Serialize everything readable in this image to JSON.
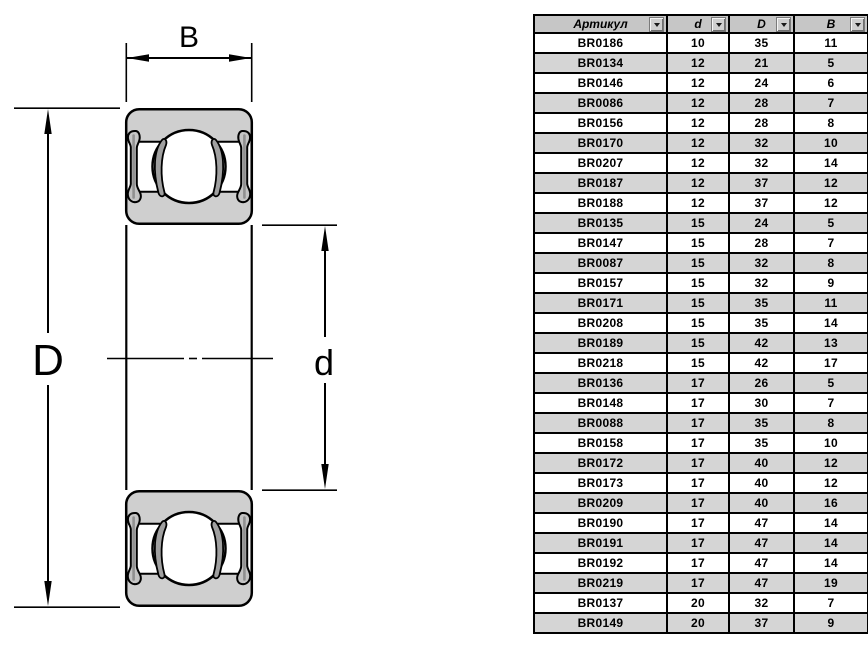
{
  "diagram": {
    "dimension_labels": {
      "width": "B",
      "outer_diameter": "D",
      "bore_diameter": "d"
    },
    "colors": {
      "body_gray": "#cfcfcf",
      "seal_gray": "#c4c4c4",
      "insert_gray": "#a0a0a0",
      "outline": "#000000"
    }
  },
  "table": {
    "columns": [
      {
        "label": "Артикул",
        "filter": true
      },
      {
        "label": "d",
        "filter": true
      },
      {
        "label": "D",
        "filter": true
      },
      {
        "label": "B",
        "filter": true
      }
    ],
    "rows": [
      [
        "BR0186",
        "10",
        "35",
        "11"
      ],
      [
        "BR0134",
        "12",
        "21",
        "5"
      ],
      [
        "BR0146",
        "12",
        "24",
        "6"
      ],
      [
        "BR0086",
        "12",
        "28",
        "7"
      ],
      [
        "BR0156",
        "12",
        "28",
        "8"
      ],
      [
        "BR0170",
        "12",
        "32",
        "10"
      ],
      [
        "BR0207",
        "12",
        "32",
        "14"
      ],
      [
        "BR0187",
        "12",
        "37",
        "12"
      ],
      [
        "BR0188",
        "12",
        "37",
        "12"
      ],
      [
        "BR0135",
        "15",
        "24",
        "5"
      ],
      [
        "BR0147",
        "15",
        "28",
        "7"
      ],
      [
        "BR0087",
        "15",
        "32",
        "8"
      ],
      [
        "BR0157",
        "15",
        "32",
        "9"
      ],
      [
        "BR0171",
        "15",
        "35",
        "11"
      ],
      [
        "BR0208",
        "15",
        "35",
        "14"
      ],
      [
        "BR0189",
        "15",
        "42",
        "13"
      ],
      [
        "BR0218",
        "15",
        "42",
        "17"
      ],
      [
        "BR0136",
        "17",
        "26",
        "5"
      ],
      [
        "BR0148",
        "17",
        "30",
        "7"
      ],
      [
        "BR0088",
        "17",
        "35",
        "8"
      ],
      [
        "BR0158",
        "17",
        "35",
        "10"
      ],
      [
        "BR0172",
        "17",
        "40",
        "12"
      ],
      [
        "BR0173",
        "17",
        "40",
        "12"
      ],
      [
        "BR0209",
        "17",
        "40",
        "16"
      ],
      [
        "BR0190",
        "17",
        "47",
        "14"
      ],
      [
        "BR0191",
        "17",
        "47",
        "14"
      ],
      [
        "BR0192",
        "17",
        "47",
        "14"
      ],
      [
        "BR0219",
        "17",
        "47",
        "19"
      ],
      [
        "BR0137",
        "20",
        "32",
        "7"
      ],
      [
        "BR0149",
        "20",
        "37",
        "9"
      ]
    ],
    "colors": {
      "header_bg": "#c6c6c6",
      "row_alt_bg": "#d5d5d5",
      "border": "#000000"
    }
  }
}
